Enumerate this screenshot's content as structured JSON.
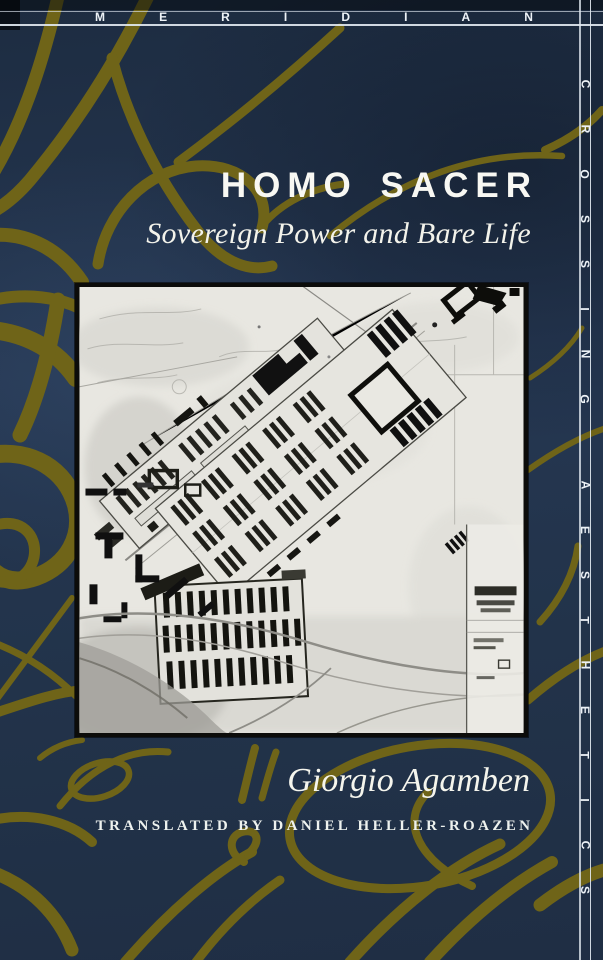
{
  "series": {
    "top_label": "MERIDIAN",
    "side_word_1": "CROSSING",
    "side_word_2": "AESTHETICS"
  },
  "title_block": {
    "title": "HOMO SACER",
    "subtitle": "Sovereign Power and Bare Life"
  },
  "author_block": {
    "author": "Giorgio Agamben",
    "translated_by": "TRANSLATED BY DANIEL HELLER-ROAZEN"
  },
  "colors": {
    "background_navy": "#22334a",
    "swirl_gold": "#6f6418",
    "rule_white": "#dfe7ef",
    "text_white": "#f5f5ed",
    "photo_paper": "#e8e7e1",
    "photo_border_black": "#0c0c0a"
  }
}
